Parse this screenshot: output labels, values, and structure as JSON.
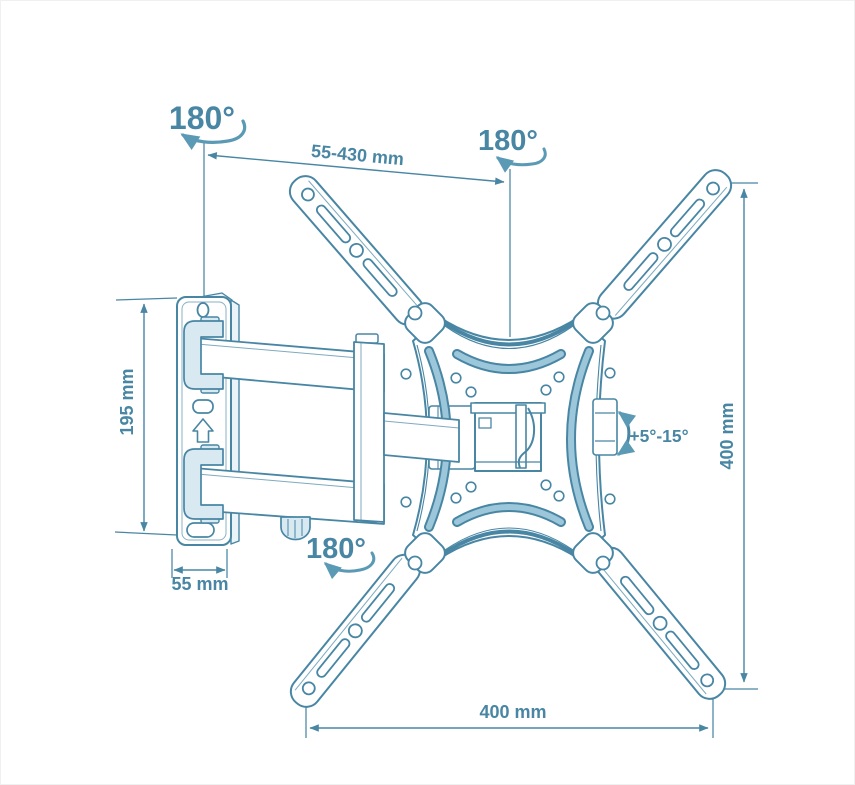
{
  "diagram": {
    "kind": "technical-line-drawing",
    "labels": {
      "swivel_top_left": "180°",
      "swivel_top_center": "180°",
      "swivel_bottom": "180°",
      "arm_extension": "55-430 mm",
      "wall_plate_height": "195 mm",
      "wall_plate_width": "55 mm",
      "tilt_range": "+5°-15°",
      "bracket_height": "400 mm",
      "bracket_width": "400 mm"
    },
    "colors": {
      "line": "#4886a4",
      "text": "#4886a4",
      "slot_fill": "#9cc6da",
      "tint_fill": "#d9e9f2",
      "background": "#ffffff"
    }
  }
}
